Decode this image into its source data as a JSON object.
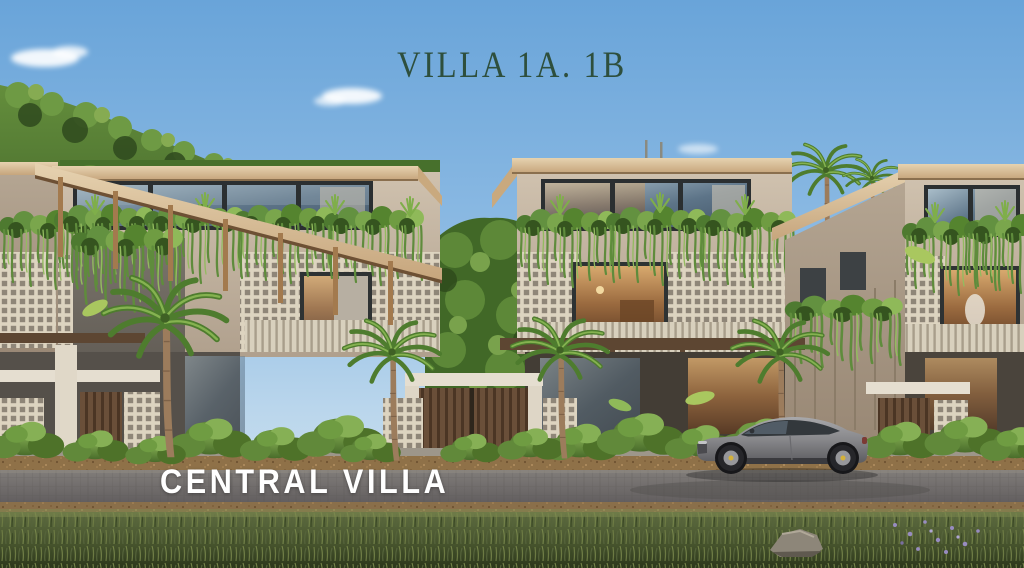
{
  "scene": {
    "title": "VILLA 1A. 1B",
    "caption": "CENTRAL VILLA"
  },
  "palette": {
    "title_text": "#2e4f3d",
    "caption_text": "#ffffff",
    "sky_top": "#69a4d9",
    "sky_horizon": "#d7e7f1",
    "foliage_dark": "#35541f",
    "foliage_mid": "#5f8c3c",
    "foliage_light": "#8fb959",
    "wall_stucco": "#c4b6a2",
    "roof_fascia": "#d6c3a4",
    "wood_trim": "#a97f52",
    "lattice_white": "#ddd4c0",
    "window_frame": "#2b2f31",
    "road_asphalt": "#6f6b68",
    "grass_green": "#4a5730",
    "car_body": "#8e8e90"
  }
}
